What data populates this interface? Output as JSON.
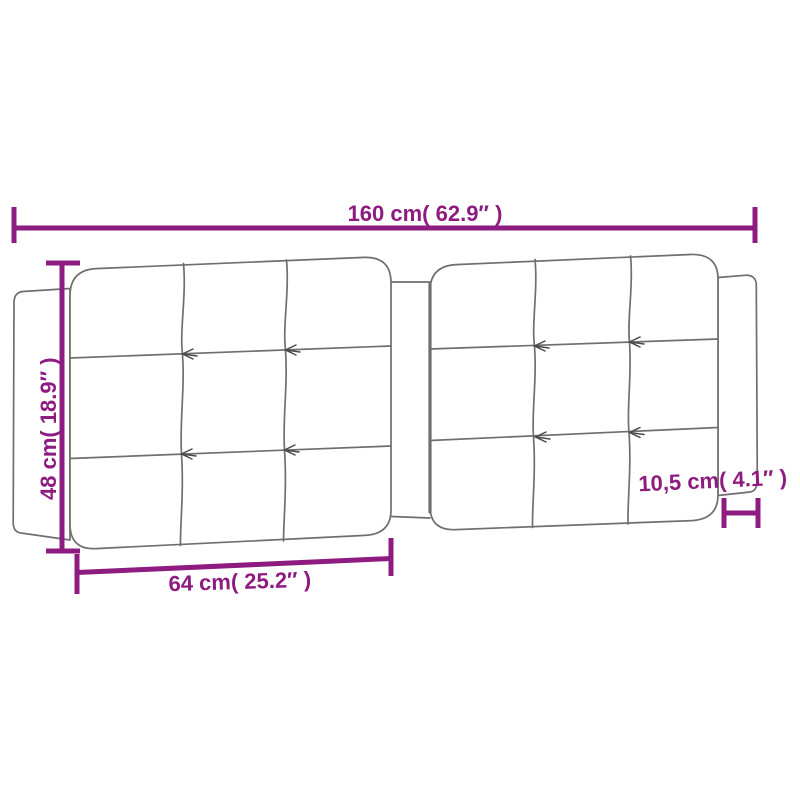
{
  "page": {
    "background": "#ffffff",
    "description": "Tufted headboard cushion dimension diagram"
  },
  "colors": {
    "dimension": "#8E1B80",
    "outline": "#6F6F6F",
    "tuft": "#4A4A4A",
    "panel_fill": "#ffffff"
  },
  "dimensions": {
    "total_width": {
      "label": "160 cm( 62.9″ )"
    },
    "height": {
      "label": "48 cm( 18.9″ )"
    },
    "panel_width": {
      "label": "64 cm( 25.2″ )"
    },
    "depth": {
      "label": "10,5 cm( 4.1″ )"
    }
  }
}
